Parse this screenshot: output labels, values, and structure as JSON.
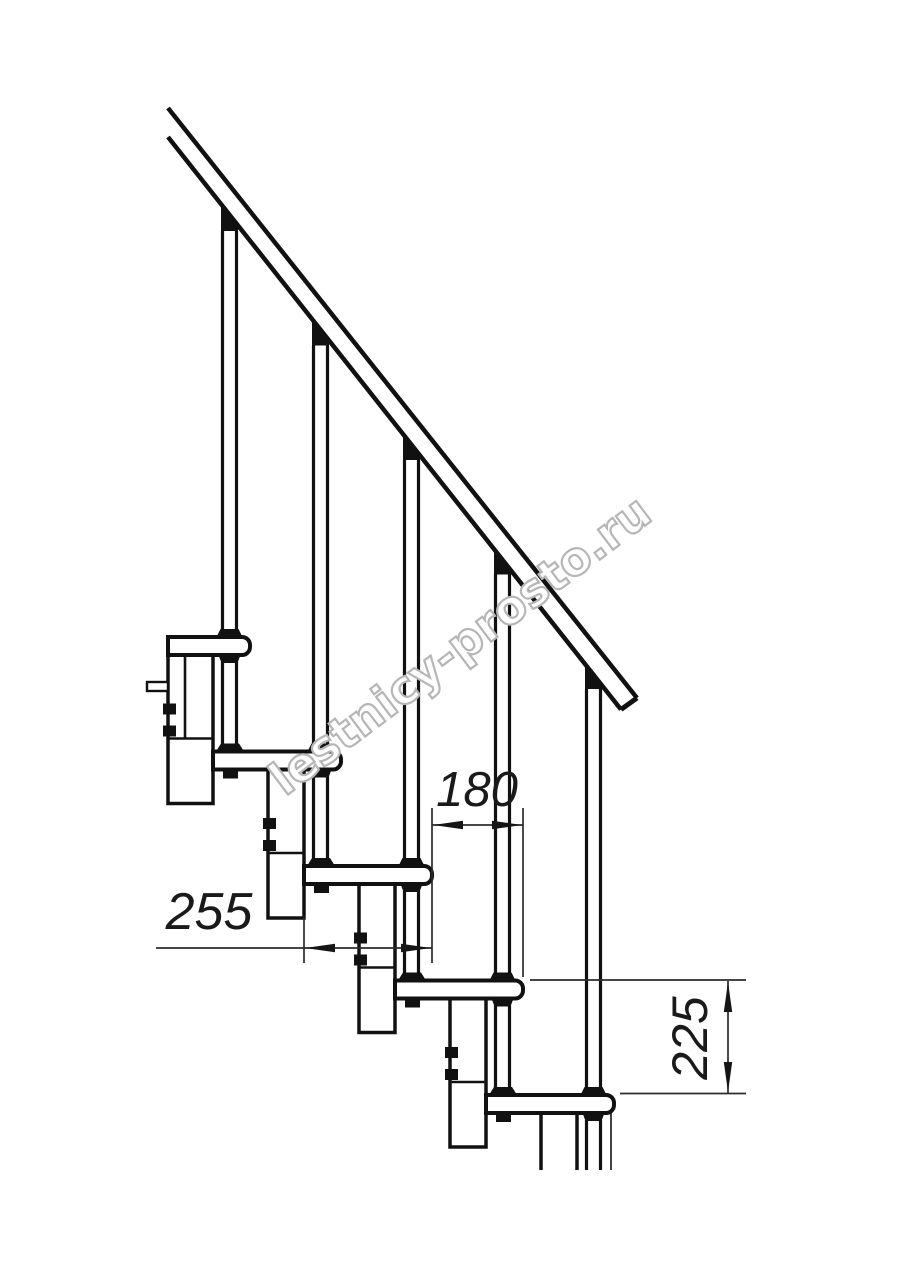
{
  "page": {
    "background": "#ffffff",
    "ink": "#111111",
    "dim_color": "#2b2b2b",
    "watermark_color": "#b6b6b6"
  },
  "drawing": {
    "title": "Modular staircase side elevation (technical drawing)",
    "watermark": "lestnicy-prosto.ru",
    "dimensions": {
      "tread_depth": "255",
      "step_run": "180",
      "riser_height": "225"
    }
  }
}
